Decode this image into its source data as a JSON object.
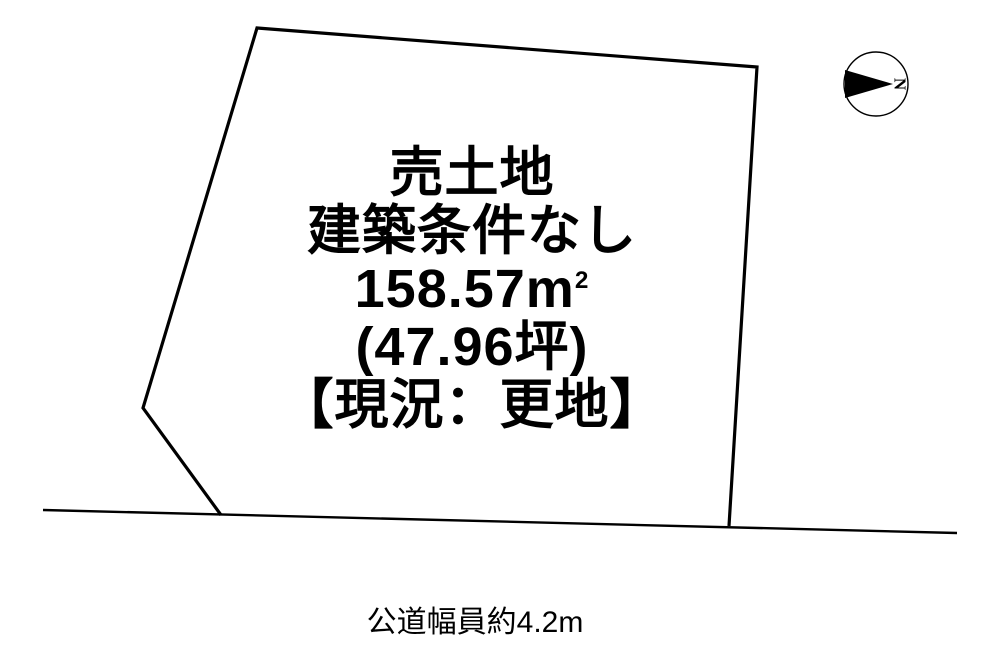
{
  "diagram": {
    "parcel": {
      "title": "売土地",
      "condition": "建築条件なし",
      "area_main": "158.57m",
      "area_sup": "2",
      "area_tsubo": "(47.96坪)",
      "status": "【現況：更地】"
    },
    "road": {
      "width_label": "公道幅員約4.2m"
    },
    "compass": {
      "north_label": "N"
    },
    "colors": {
      "line": "#000000",
      "text": "#000000",
      "background": "#ffffff"
    }
  }
}
